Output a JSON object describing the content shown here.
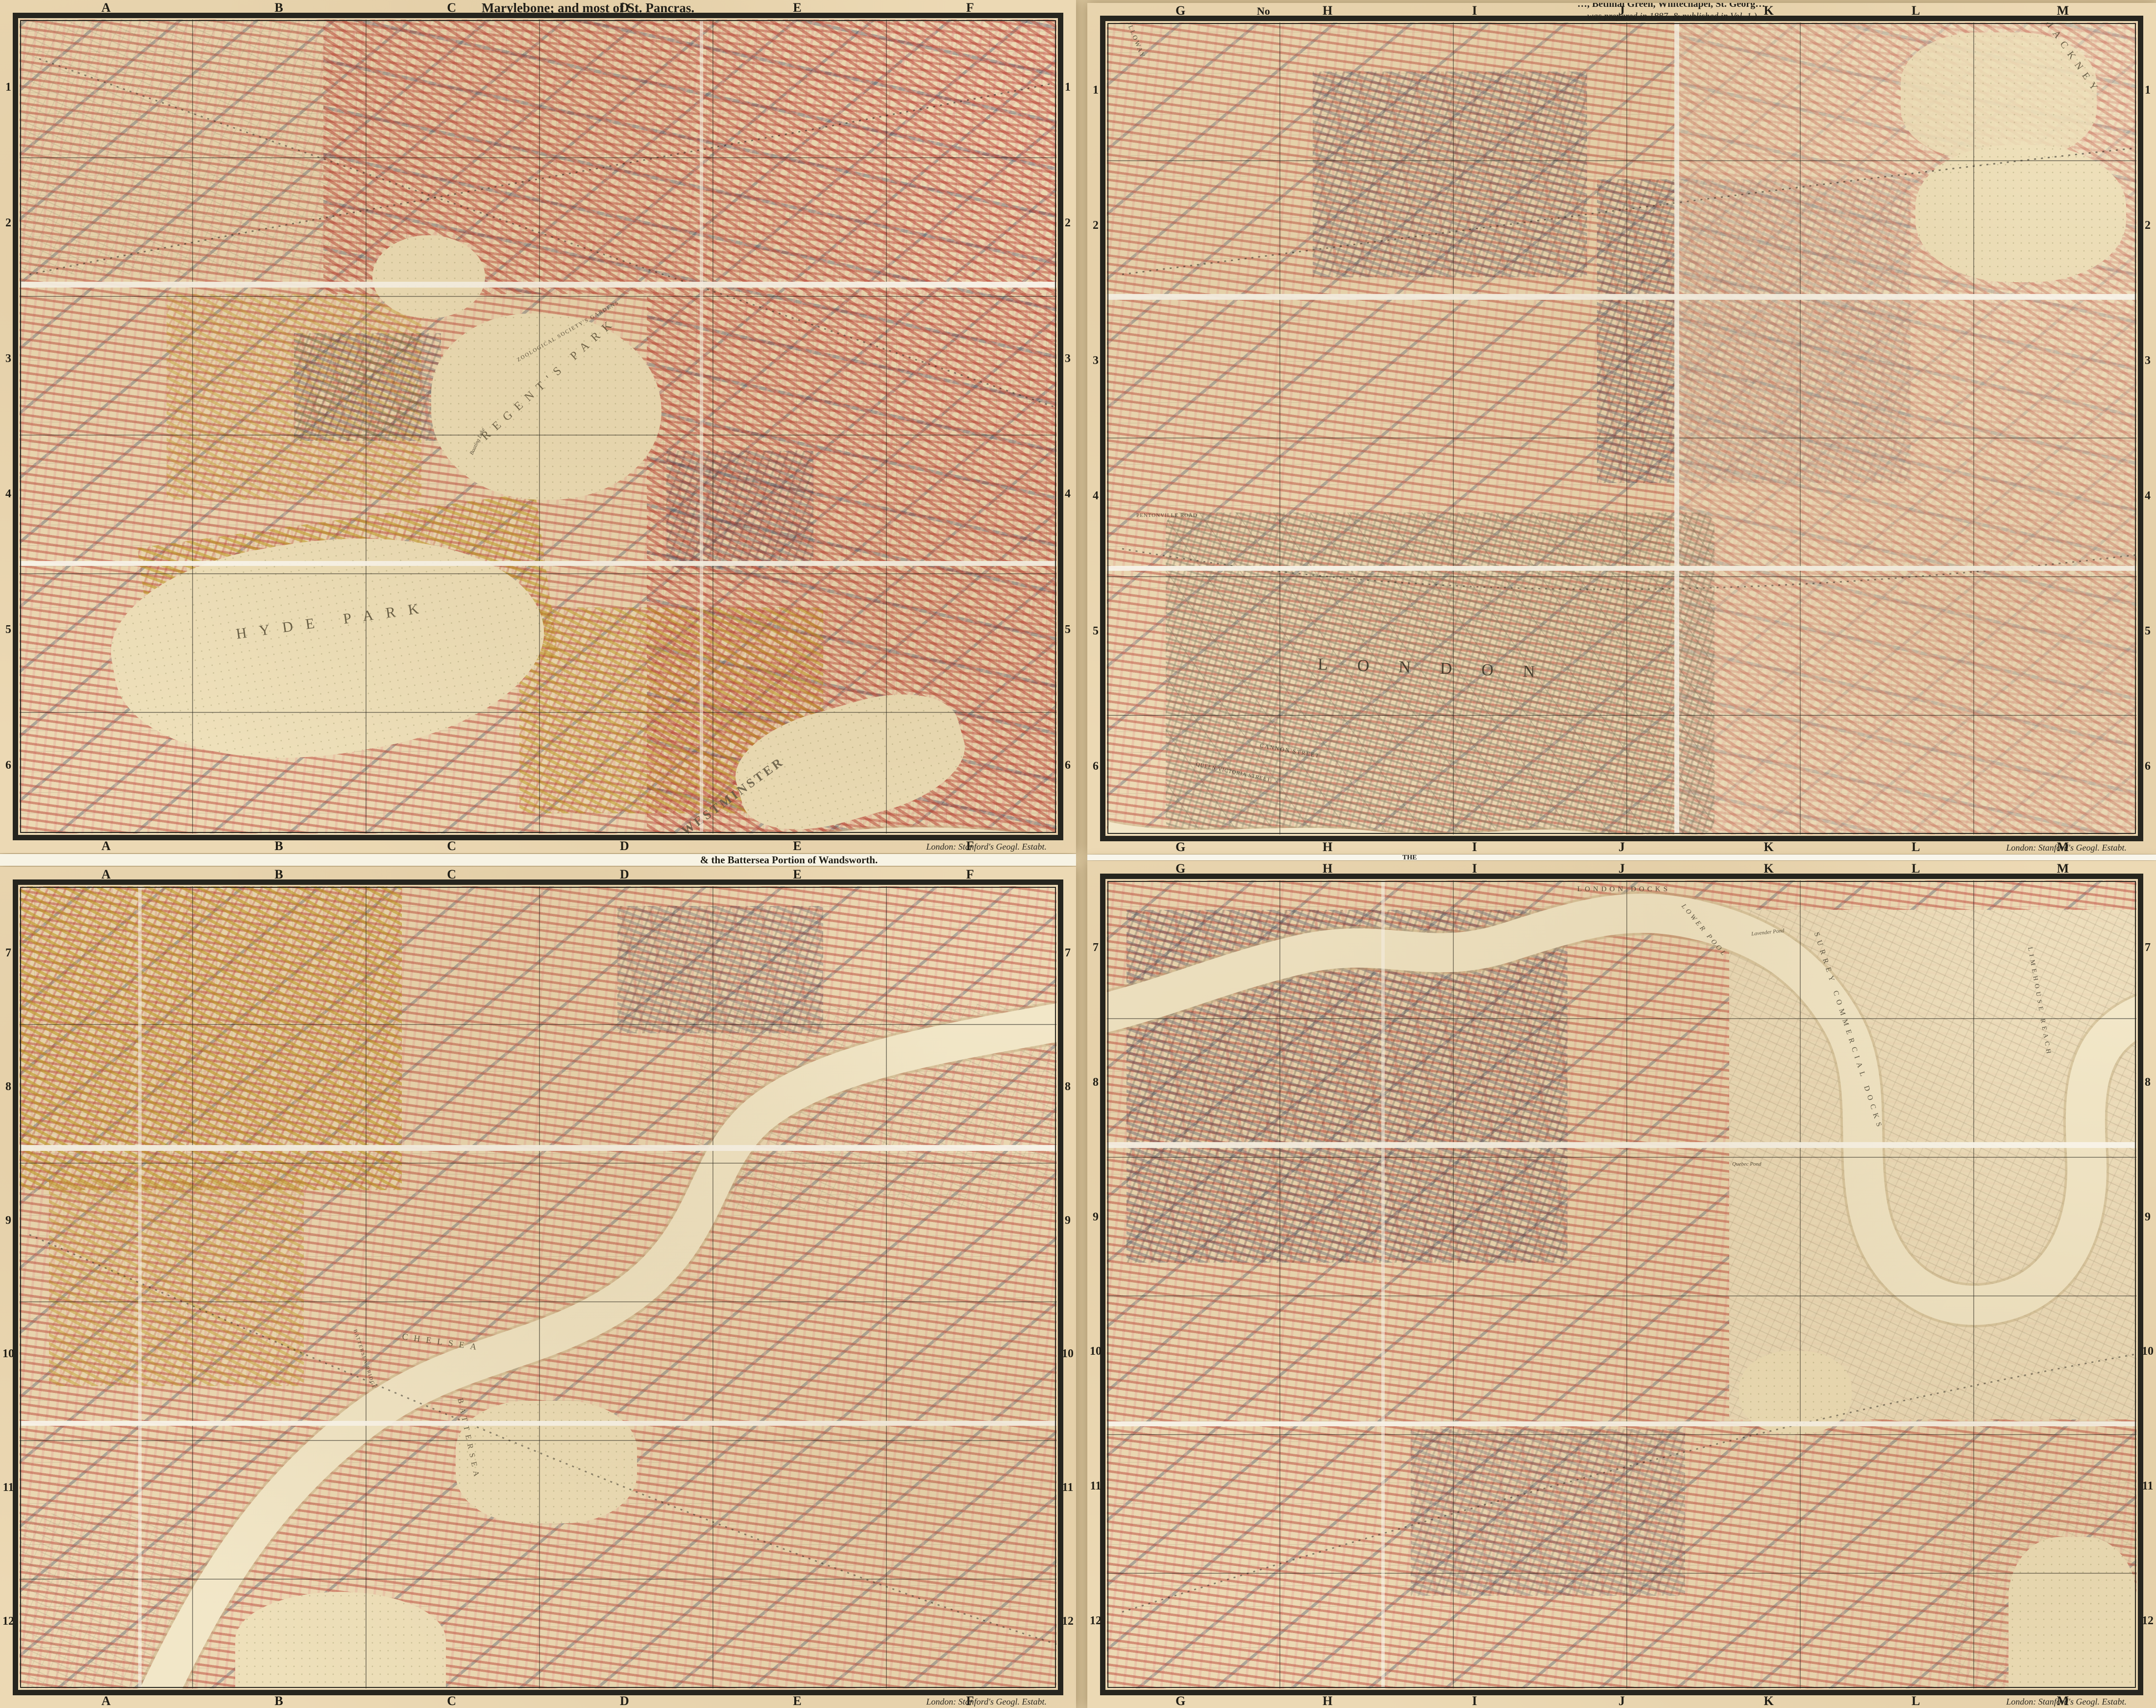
{
  "sheets": {
    "top_left": {
      "title": "Marylebone; and most of St. Pancras."
    },
    "top_right": {
      "corner_fragment": "No",
      "note_fragment_top": "…, Bethnal Green, Whitechapel, St. Georg…",
      "note_line": "was prepared in 1887, & published in Vol. 1.)"
    },
    "bottom_left": {
      "title": "& the Battersea Portion of Wandsworth."
    },
    "bottom_right": {
      "top_fragment": "THE"
    }
  },
  "imprint": "London: Stanford's Geogl. Estabt.",
  "grid": {
    "columns_left": [
      "A",
      "B",
      "C",
      "D",
      "E",
      "F"
    ],
    "columns_right": [
      "G",
      "H",
      "I",
      "J",
      "K",
      "L",
      "M"
    ],
    "rows_top": [
      "1",
      "2",
      "3",
      "4",
      "5",
      "6"
    ],
    "rows_bottom": [
      "7",
      "8",
      "9",
      "10",
      "11",
      "12"
    ]
  },
  "labels": {
    "hyde_park": "HYDE PARK",
    "regents_park": "REGENT'S PARK",
    "zoo": "ZOOLOGICAL SOCIETY'S GARDENS",
    "boating_lake": "Boating Lake",
    "westminster": "WESTMINSTER",
    "holloway": "HOLLOWAY",
    "london_city": "LONDON",
    "hackney": "HACKNEY",
    "pentonville": "PENTONVILLE ROAD",
    "cannon_street": "CANNON STREET",
    "queen_victoria_street": "QUEEN VICTORIA STREET",
    "chelsea": "CHELSEA",
    "battersea": "BATTERSEA",
    "battersea_bridge": "BATTERSEA BRIDGE",
    "london_docks": "LONDON DOCKS",
    "lower_pool": "LOWER POOL",
    "surrey_docks": "SURREY COMMERCIAL DOCKS",
    "limehouse_reach": "LIMEHOUSE REACH",
    "lavender_pond": "Lavender Pond",
    "quebec_pond": "Quebec Pond"
  },
  "colors": {
    "parchment": "#ecd9b4",
    "poverty_red": "#b5372c",
    "poverty_pink": "#e3a595",
    "poverty_yellow": "#c3a01e",
    "poverty_dark_blue": "#2c3a5d",
    "city_gray": "#a9a188",
    "water": "#f0e2c0",
    "frame_black": "#26251e",
    "seam_white": "#fbf8ee"
  }
}
